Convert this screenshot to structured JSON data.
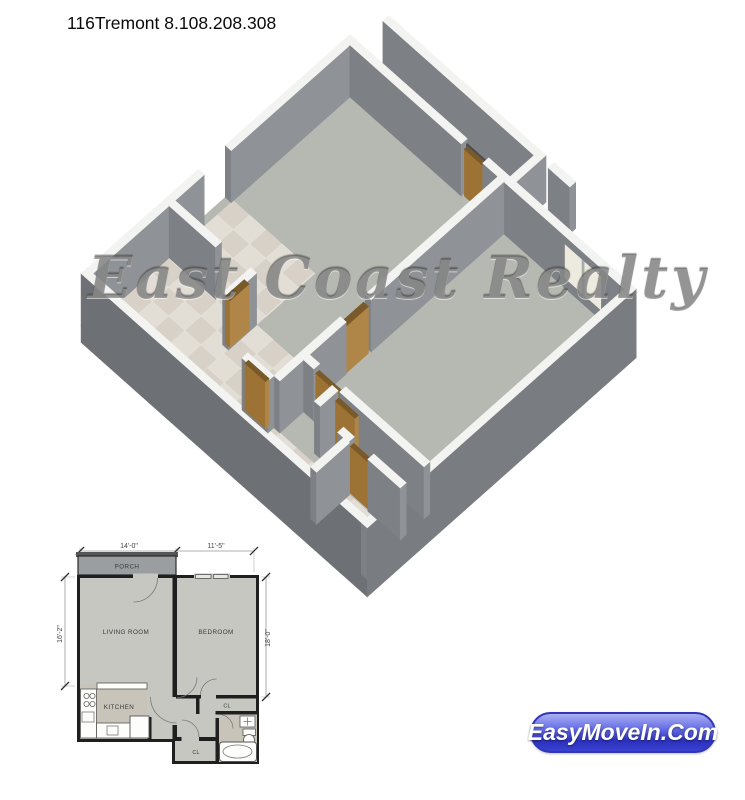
{
  "title": "116Tremont 8.108.208.308",
  "watermark": "East Coast Realty",
  "badge": {
    "label": "EasyMoveIn.Com"
  },
  "plan_2d": {
    "room_labels": {
      "porch": "PORCH",
      "living_room": "LIVING ROOM",
      "bedroom": "BEDROOM",
      "kitchen": "KITCHEN",
      "closet_bedroom": "CL",
      "closet_hall": "CL"
    },
    "dimensions": {
      "top_left": "14'-0\"",
      "top_right": "11'-5\"",
      "left": "16'-2\"",
      "right": "18'-0\""
    }
  },
  "colors": {
    "wall_outer_dark": "#6d7074",
    "wall_outer_mid": "#797c80",
    "wall_face_south": "#7d8084",
    "wall_face_east": "#8f9296",
    "wall_top": "#f3f3f1",
    "floor": "#b6b9b1",
    "tile": "#d7d1c7",
    "porch_floor": "#a6a9a2",
    "door_brown_s": "#9c7335",
    "door_brown_e": "#b08648",
    "door_brown_t": "#7a5a28",
    "window_pane": "#edebdf",
    "plan2d_room_fill": "#c5c7c0",
    "plan2d_porch_fill": "#9b9ea1",
    "plan2d_wall": "#1f1f1f",
    "badge_blue": "#2b31bd",
    "watermark_gray": "#585858"
  }
}
